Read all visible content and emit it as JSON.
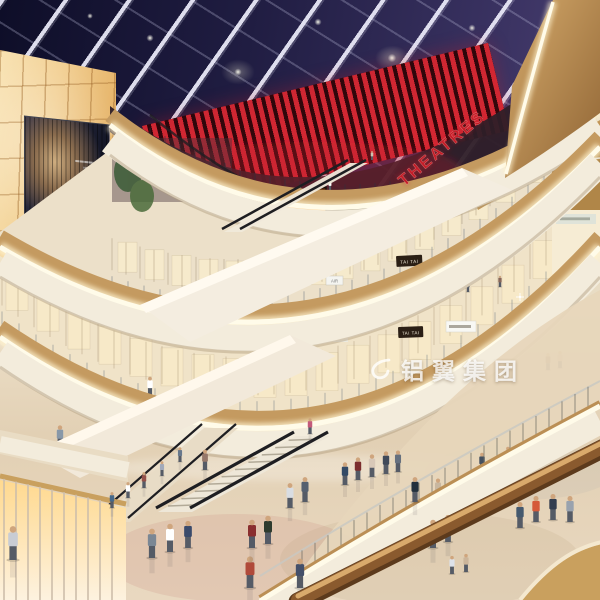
{
  "signs": {
    "theatres": "THEATRES",
    "tai_tai_upper": "TAI TAI",
    "tai_tai_lower": "TAI TAI",
    "air": "AIR"
  },
  "watermark": {
    "text": "铝翼集团"
  },
  "colors": {
    "theatres_red": "#c41d28",
    "marquee_red": "#b5121b",
    "ceiling_navy": "#1a1838",
    "wood": "#c49a60",
    "glow_warm": "#fff6dd",
    "wall_amber": "#f2cf92",
    "fascia_cream": "#f3ecdc",
    "watermark_white": "rgba(255,255,255,0.8)"
  }
}
